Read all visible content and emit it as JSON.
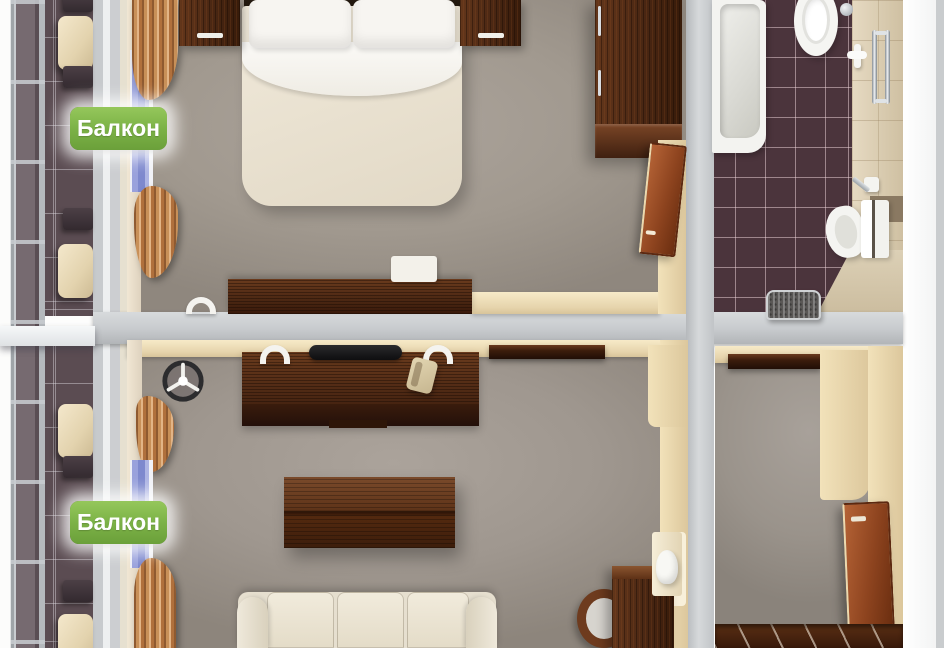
{
  "labels": {
    "balcony_top": "Балкон",
    "balcony_bottom": "Балкон"
  },
  "palette": {
    "label_green": "#7cb247",
    "label_text": "#ffffff",
    "wall_gray": "#c9cccf",
    "carpet": "#a1998f",
    "bathroom_tile": "#4b343c",
    "balcony_tile": "#5b4c52",
    "furniture_wood": "#4e2914",
    "door_wood": "#8e441f",
    "cream_wall": "#ecd9b2",
    "bedding_white": "#f0e9da",
    "window_blue": "#8a93d4"
  }
}
